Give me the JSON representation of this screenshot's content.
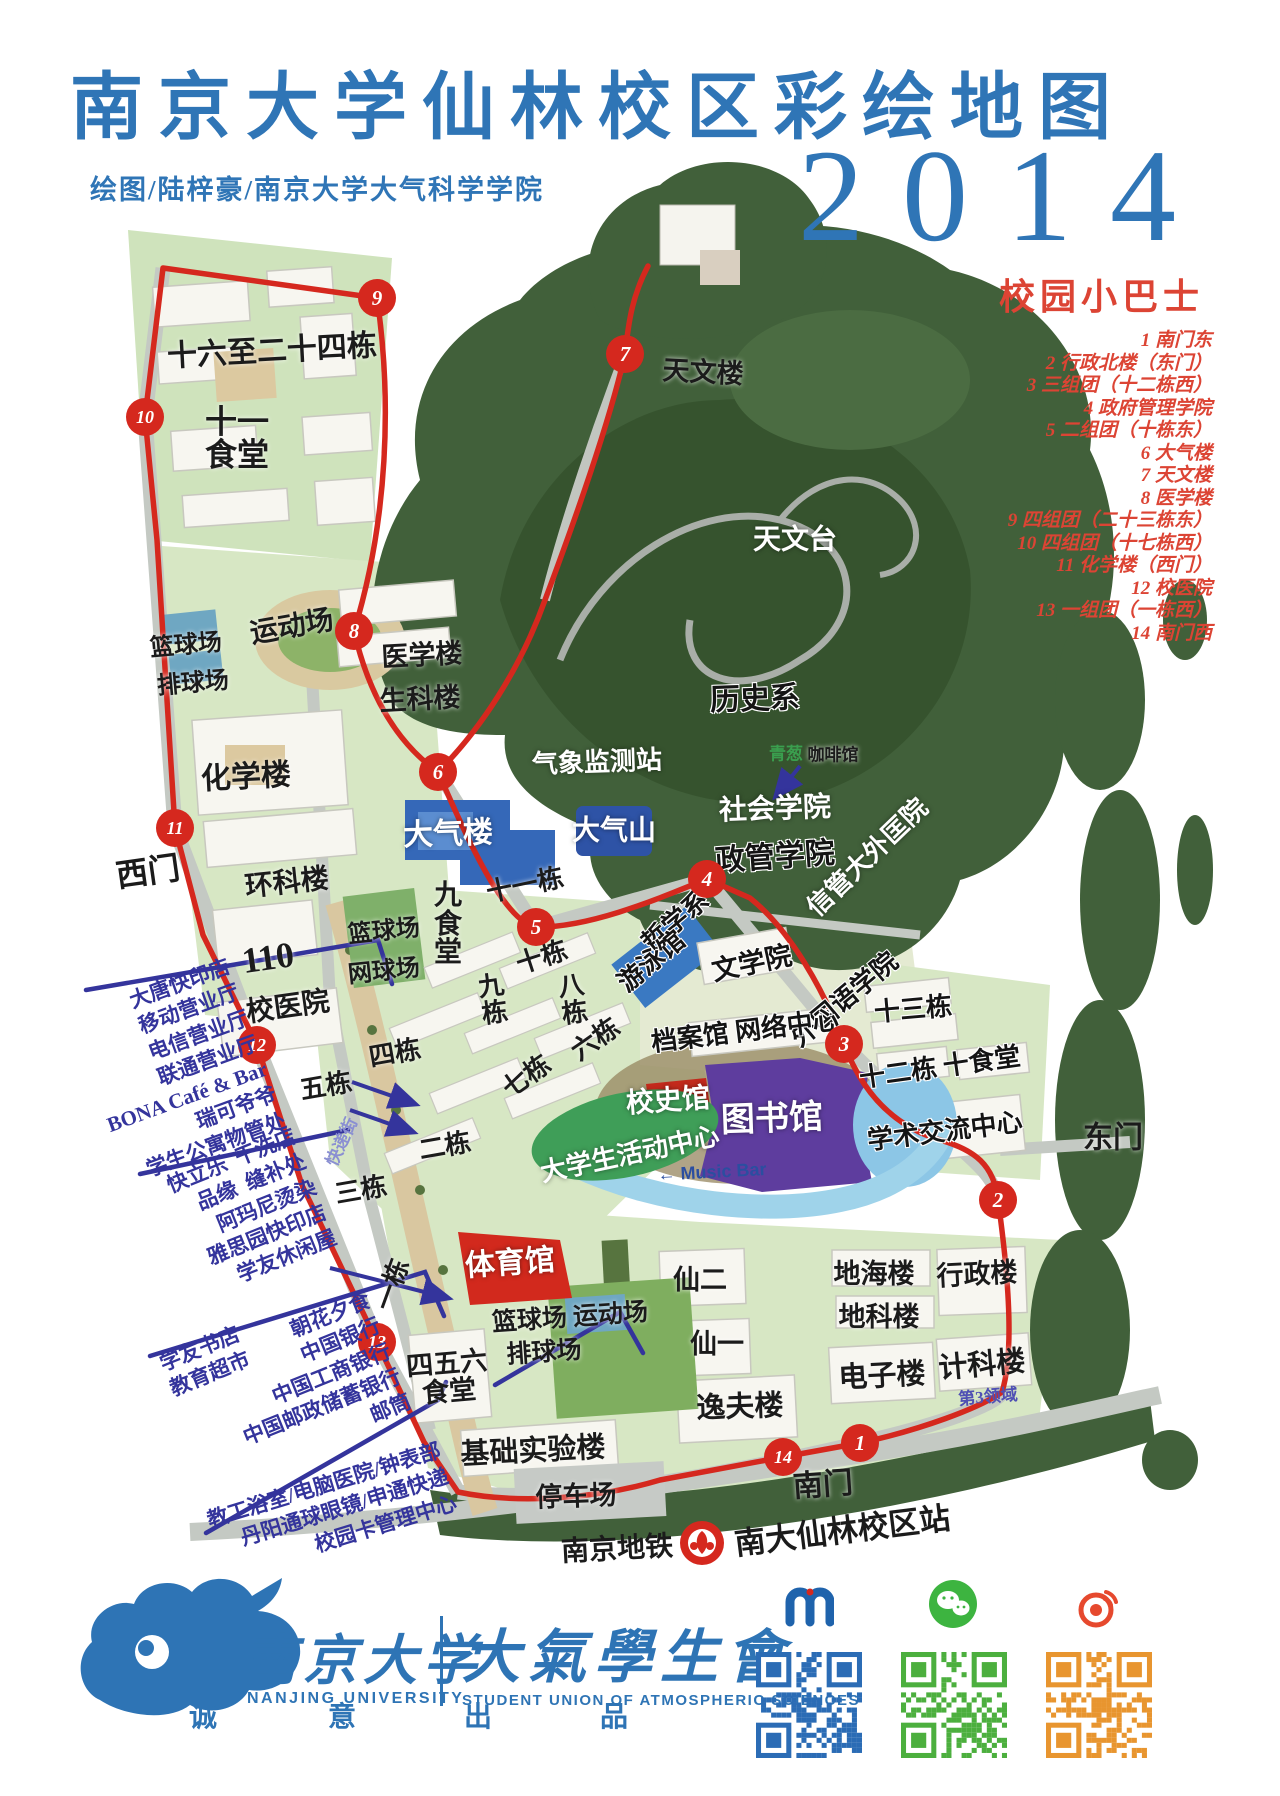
{
  "header": {
    "title": "南京大学仙林校区彩绘地图",
    "credit": "绘图/陆梓豪/南京大学大气科学学院",
    "year": "2014"
  },
  "bus": {
    "title": "校园小巴士",
    "stops": [
      "1 南门东",
      "2 行政北楼（东门）",
      "3 三组团（十二栋西）",
      "4 政府管理学院",
      "5 二组团（十栋东）",
      "6 大气楼",
      "7 天文楼",
      "8 医学楼",
      "9 四组团（二十三栋东）",
      "10 四组团（十七栋西）",
      "11 化学楼（西门）",
      "12 校医院",
      "13 一组团（一栋西）",
      "14 南门西"
    ]
  },
  "map": {
    "labels": [
      {
        "t": "十六至二十四栋",
        "x": 272,
        "y": 352,
        "s": 30,
        "r": -3,
        "c": "bk"
      },
      {
        "t": "十一\n食堂",
        "x": 237,
        "y": 438,
        "s": 32,
        "r": 0,
        "c": "bk"
      },
      {
        "t": "运动场",
        "x": 292,
        "y": 628,
        "s": 28,
        "r": -10,
        "c": "bk"
      },
      {
        "t": "篮球场",
        "x": 186,
        "y": 646,
        "s": 24,
        "r": -5,
        "c": "bk"
      },
      {
        "t": "排球场",
        "x": 193,
        "y": 684,
        "s": 24,
        "r": -5,
        "c": "bk"
      },
      {
        "t": "医学楼",
        "x": 422,
        "y": 656,
        "s": 27,
        "r": -3,
        "c": "bk"
      },
      {
        "t": "生科楼",
        "x": 420,
        "y": 700,
        "s": 27,
        "r": -3,
        "c": "bk"
      },
      {
        "t": "化学楼",
        "x": 246,
        "y": 778,
        "s": 30,
        "r": -3,
        "c": "bk"
      },
      {
        "t": "西门",
        "x": 148,
        "y": 872,
        "s": 32,
        "r": -8,
        "c": "bk"
      },
      {
        "t": "环科楼",
        "x": 287,
        "y": 884,
        "s": 28,
        "r": -6,
        "c": "bk"
      },
      {
        "t": "110",
        "x": 268,
        "y": 958,
        "s": 36,
        "r": -8,
        "c": "bk"
      },
      {
        "t": "篮球场",
        "x": 384,
        "y": 932,
        "s": 24,
        "r": -6,
        "c": "bk"
      },
      {
        "t": "网球场",
        "x": 384,
        "y": 972,
        "s": 24,
        "r": -6,
        "c": "bk"
      },
      {
        "t": "校医院",
        "x": 288,
        "y": 1008,
        "s": 28,
        "r": -8,
        "c": "bk"
      },
      {
        "t": "天文楼",
        "x": 703,
        "y": 373,
        "s": 27,
        "r": 3,
        "c": "bk"
      },
      {
        "t": "天文台",
        "x": 795,
        "y": 541,
        "s": 28,
        "r": 0,
        "c": "wh"
      },
      {
        "t": "历史系",
        "x": 755,
        "y": 700,
        "s": 30,
        "r": -2,
        "c": "bw"
      },
      {
        "t": "气象监测站",
        "x": 597,
        "y": 763,
        "s": 26,
        "r": -2,
        "c": "wh"
      },
      {
        "t": "青葱",
        "x": 786,
        "y": 754,
        "s": 17,
        "r": 0,
        "c": "gr"
      },
      {
        "t": "咖啡馆",
        "x": 833,
        "y": 755,
        "s": 17,
        "r": 0,
        "c": "bk"
      },
      {
        "t": "社会学院",
        "x": 775,
        "y": 810,
        "s": 28,
        "r": -2,
        "c": "wh"
      },
      {
        "t": "政管学院",
        "x": 775,
        "y": 858,
        "s": 30,
        "r": -4,
        "c": "bw"
      },
      {
        "t": "信管大外匡院",
        "x": 868,
        "y": 858,
        "s": 26,
        "r": -44,
        "c": "wh"
      },
      {
        "t": "哲学系",
        "x": 676,
        "y": 922,
        "s": 26,
        "r": -40,
        "c": "bw"
      },
      {
        "t": "外国语学院",
        "x": 845,
        "y": 1000,
        "s": 26,
        "r": -40,
        "c": "bw"
      },
      {
        "t": "游泳馆",
        "x": 652,
        "y": 962,
        "s": 26,
        "r": -40,
        "c": "bw"
      },
      {
        "t": "文学院",
        "x": 752,
        "y": 964,
        "s": 27,
        "r": -12,
        "c": "bw"
      },
      {
        "t": "档案馆 网络中心",
        "x": 745,
        "y": 1032,
        "s": 26,
        "r": -7,
        "c": "bw"
      },
      {
        "t": "十三栋",
        "x": 913,
        "y": 1010,
        "s": 26,
        "r": -5,
        "c": "bw"
      },
      {
        "t": "大气楼",
        "x": 448,
        "y": 835,
        "s": 30,
        "r": -2,
        "c": "wh"
      },
      {
        "t": "大气山",
        "x": 614,
        "y": 832,
        "s": 28,
        "r": 0,
        "c": "wh"
      },
      {
        "t": "九\n食\n堂",
        "x": 448,
        "y": 925,
        "s": 28,
        "r": 0,
        "c": "bk"
      },
      {
        "t": "十一栋",
        "x": 525,
        "y": 886,
        "s": 26,
        "r": -12,
        "c": "bk"
      },
      {
        "t": "十栋",
        "x": 542,
        "y": 958,
        "s": 26,
        "r": -18,
        "c": "bk"
      },
      {
        "t": "九\n栋",
        "x": 493,
        "y": 1000,
        "s": 26,
        "r": -8,
        "c": "bk"
      },
      {
        "t": "八\n栋",
        "x": 573,
        "y": 1000,
        "s": 26,
        "r": -8,
        "c": "bk"
      },
      {
        "t": "六栋",
        "x": 596,
        "y": 1040,
        "s": 26,
        "r": -35,
        "c": "bk"
      },
      {
        "t": "七栋",
        "x": 527,
        "y": 1077,
        "s": 26,
        "r": -35,
        "c": "bk"
      },
      {
        "t": "校史馆",
        "x": 668,
        "y": 1102,
        "s": 28,
        "r": -4,
        "c": "wh"
      },
      {
        "t": "图书馆",
        "x": 772,
        "y": 1120,
        "s": 34,
        "r": -2,
        "c": "wh"
      },
      {
        "t": "大学生活动中心",
        "x": 630,
        "y": 1155,
        "s": 26,
        "r": -12,
        "c": "wh"
      },
      {
        "t": "学术交流中心",
        "x": 945,
        "y": 1132,
        "s": 26,
        "r": -7,
        "c": "bw"
      },
      {
        "t": "十二栋 十食堂",
        "x": 940,
        "y": 1068,
        "s": 26,
        "r": -8,
        "c": "bw"
      },
      {
        "t": "东门",
        "x": 1113,
        "y": 1139,
        "s": 30,
        "r": 0,
        "c": "bk"
      },
      {
        "t": "← Music Bar",
        "x": 712,
        "y": 1172,
        "s": 18,
        "r": -3,
        "c": "bl"
      },
      {
        "t": "五栋",
        "x": 326,
        "y": 1087,
        "s": 26,
        "r": -10,
        "c": "bk"
      },
      {
        "t": "四栋",
        "x": 395,
        "y": 1054,
        "s": 26,
        "r": -10,
        "c": "bk"
      },
      {
        "t": "快递街",
        "x": 342,
        "y": 1142,
        "s": 17,
        "r": -65,
        "c": "lv"
      },
      {
        "t": "二栋",
        "x": 445,
        "y": 1147,
        "s": 26,
        "r": -10,
        "c": "bk"
      },
      {
        "t": "三栋",
        "x": 361,
        "y": 1191,
        "s": 26,
        "r": -10,
        "c": "bk"
      },
      {
        "t": "一栋",
        "x": 393,
        "y": 1285,
        "s": 26,
        "r": -70,
        "c": "bk"
      },
      {
        "t": "体育馆",
        "x": 510,
        "y": 1264,
        "s": 30,
        "r": -4,
        "c": "wh"
      },
      {
        "t": "篮球场 运动场",
        "x": 570,
        "y": 1318,
        "s": 25,
        "r": -4,
        "c": "bk"
      },
      {
        "t": "排球场",
        "x": 544,
        "y": 1353,
        "s": 25,
        "r": -4,
        "c": "bk"
      },
      {
        "t": "仙二",
        "x": 700,
        "y": 1281,
        "s": 27,
        "r": 0,
        "c": "bk"
      },
      {
        "t": "仙一",
        "x": 717,
        "y": 1345,
        "s": 27,
        "r": 0,
        "c": "bk"
      },
      {
        "t": "地海楼",
        "x": 874,
        "y": 1275,
        "s": 27,
        "r": 0,
        "c": "bk"
      },
      {
        "t": "地科楼",
        "x": 879,
        "y": 1318,
        "s": 27,
        "r": 0,
        "c": "bk"
      },
      {
        "t": "行政楼",
        "x": 977,
        "y": 1275,
        "s": 27,
        "r": -3,
        "c": "bk"
      },
      {
        "t": "电子楼",
        "x": 882,
        "y": 1377,
        "s": 29,
        "r": -3,
        "c": "bk"
      },
      {
        "t": "计科楼",
        "x": 982,
        "y": 1366,
        "s": 29,
        "r": -5,
        "c": "bk"
      },
      {
        "t": "第3领域",
        "x": 988,
        "y": 1397,
        "s": 17,
        "r": -5,
        "c": "vi"
      },
      {
        "t": "四五六\n食堂",
        "x": 448,
        "y": 1378,
        "s": 27,
        "r": -5,
        "c": "bk"
      },
      {
        "t": "基础实验楼",
        "x": 533,
        "y": 1452,
        "s": 29,
        "r": -3,
        "c": "bk"
      },
      {
        "t": "逸夫楼",
        "x": 740,
        "y": 1408,
        "s": 29,
        "r": -2,
        "c": "bk"
      },
      {
        "t": "停车场",
        "x": 576,
        "y": 1497,
        "s": 27,
        "r": -2,
        "c": "bk"
      },
      {
        "t": "南门",
        "x": 823,
        "y": 1486,
        "s": 30,
        "r": -4,
        "c": "bk"
      }
    ],
    "route_stops": [
      {
        "n": "9",
        "x": 377,
        "y": 298
      },
      {
        "n": "10",
        "x": 145,
        "y": 417
      },
      {
        "n": "7",
        "x": 625,
        "y": 354
      },
      {
        "n": "8",
        "x": 354,
        "y": 631
      },
      {
        "n": "6",
        "x": 438,
        "y": 772
      },
      {
        "n": "11",
        "x": 175,
        "y": 828
      },
      {
        "n": "4",
        "x": 707,
        "y": 879
      },
      {
        "n": "5",
        "x": 536,
        "y": 927
      },
      {
        "n": "12",
        "x": 257,
        "y": 1045
      },
      {
        "n": "3",
        "x": 844,
        "y": 1044
      },
      {
        "n": "2",
        "x": 998,
        "y": 1200
      },
      {
        "n": "13",
        "x": 377,
        "y": 1342
      },
      {
        "n": "14",
        "x": 783,
        "y": 1457
      },
      {
        "n": "1",
        "x": 860,
        "y": 1443
      }
    ],
    "service_lists": [
      {
        "x": 178,
        "y": 1072,
        "r": -20,
        "items": [
          "大唐快印店",
          "移动营业厅",
          "电信营业厅",
          "联通营业厅",
          "BONA Café & Bar",
          "瑞可爷爷",
          "学生公寓物管处"
        ]
      },
      {
        "x": 252,
        "y": 1212,
        "r": -22,
        "items": [
          "快立乐  干洗店",
          "品缘  缝补处",
          "阿玛尼烫染",
          "雅思园快印店",
          "学友休闲屋"
        ]
      },
      {
        "x": 205,
        "y": 1362,
        "r": -22,
        "items": [
          "学友书店",
          "教育超市"
        ]
      },
      {
        "x": 312,
        "y": 1382,
        "r": -22,
        "items": [
          "朝花夕食",
          "中国银行",
          "中国工商银行",
          "中国邮政储蓄银行",
          "邮筒"
        ]
      },
      {
        "x": 332,
        "y": 1512,
        "r": -17,
        "items": [
          "教工浴室/电脑医院/钟表部",
          "丹阳通球眼镜/申通快递",
          "校园卡管理中心"
        ]
      }
    ],
    "metro": {
      "prefix": "南京地铁",
      "station": "南大仙林校区站"
    }
  },
  "footer": {
    "nju_cn": "南京大学",
    "nju_en": "NANJING UNIVERSITY",
    "union_cn": "大氣學生會",
    "union_en": "STUDENT UNION OF ATMOSPHERIC SCIENCES",
    "motto": [
      "诚",
      "意",
      "出",
      "品"
    ],
    "qr_colors": [
      "#2b6cb5",
      "#4caf3e",
      "#e8952f"
    ]
  },
  "colors": {
    "accent_blue": "#2f75b6",
    "route_red": "#d5281e",
    "list_red": "#dc4434",
    "annotation_indigo": "#34349c",
    "forest_green": "#41603a",
    "campus_green": "#d7e7c4",
    "water_blue": "#8cc6e6",
    "library_purple": "#5e3d9e",
    "gym_red": "#d2291d",
    "atmos_blue": "#3568b8"
  }
}
